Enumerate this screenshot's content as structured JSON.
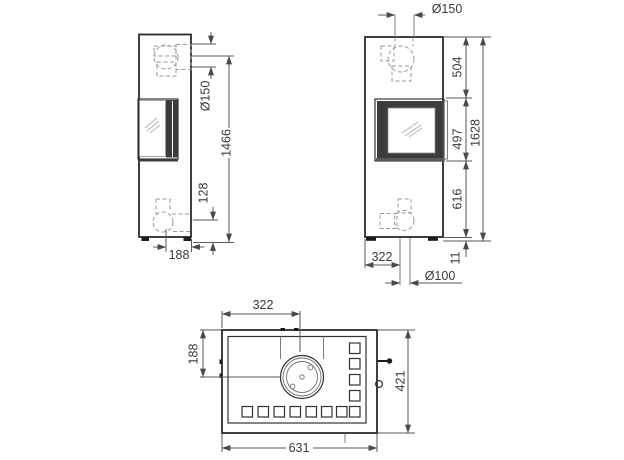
{
  "colors": {
    "ink": "#2b2b2b",
    "dimension_lines": "#5a5a5a",
    "dashed_hidden_lines": "#9a9a9a",
    "door_frame_fill": "#3c3c3c",
    "background": "#ffffff"
  },
  "views": {
    "side": {
      "title": "side-view",
      "dims": {
        "flue_diameter": "Ø150",
        "flue_center_height": "1466",
        "intake_center_height": "128",
        "intake_depth": "188"
      }
    },
    "front": {
      "title": "front-view",
      "dims": {
        "flue_diameter": "Ø150",
        "top_to_window": "504",
        "window_height": "497",
        "total_height": "1628",
        "window_to_base": "616",
        "foot_height": "11",
        "intake_offset": "322",
        "intake_diameter": "Ø100"
      }
    },
    "top": {
      "title": "top-view",
      "dims": {
        "flue_offset_from_left": "322",
        "flue_offset_from_back": "188",
        "depth": "421",
        "width": "631"
      }
    }
  }
}
